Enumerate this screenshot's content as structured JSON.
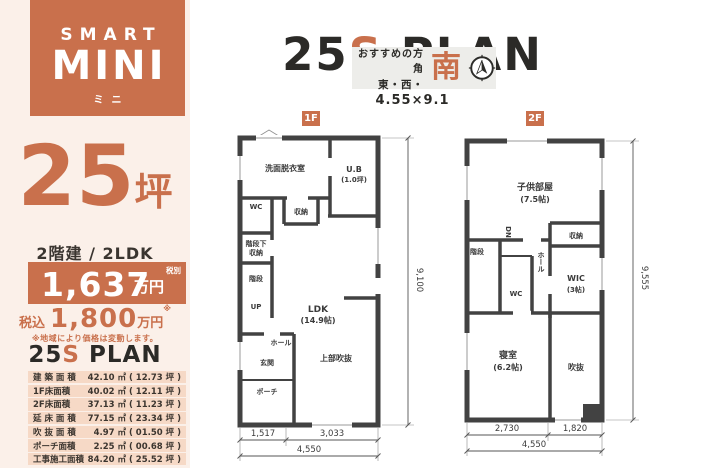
{
  "colors": {
    "accent": "#c9704c",
    "dark": "#2b2a27",
    "wall": "#424242",
    "sidebar_bg": "#fbf0e9",
    "row_bg": "#f6d9c6",
    "box_bg": "#ededea"
  },
  "brand": {
    "line1": "SMART",
    "line2": "MINI",
    "line3": "ミニ"
  },
  "sidebar": {
    "tsubo_number": "25",
    "tsubo_unit": "坪",
    "type_line": "2階建 / 2LDK",
    "price_banner": {
      "value": "1,637",
      "unit": "万円",
      "tax_note": "税別"
    },
    "tax_included": {
      "label": "税込",
      "value": "1,800",
      "unit": "万円",
      "note_mark": "※"
    },
    "disclaimer": "※地域により価格は変動します。",
    "plan_title": {
      "num": "25",
      "s": "S",
      "plan": " PLAN"
    },
    "area_table": [
      {
        "label": "建 築 面 積",
        "value": "42.10 ㎡ ( 12.73 坪 )"
      },
      {
        "label": "1F床面積",
        "value": "40.02 ㎡ ( 12.11 坪 )"
      },
      {
        "label": "2F床面積",
        "value": "37.13 ㎡ ( 11.23 坪 )"
      },
      {
        "label": "延 床 面 積",
        "value": "77.15 ㎡ ( 23.34 坪 )"
      },
      {
        "label": "吹 抜 面 積",
        "value": "4.97 ㎡ ( 01.50 坪 )"
      },
      {
        "label": "ポーチ面積",
        "value": "2.25 ㎡ ( 00.68 坪 )"
      },
      {
        "label": "工事施工面積",
        "value": "84.20 ㎡ ( 25.52 坪 )"
      }
    ]
  },
  "header": {
    "title": {
      "num": "25",
      "s": "S",
      "plan": " PLAN"
    },
    "direction": {
      "label": "おすすめの方角",
      "directions": "東・西・",
      "main_direction": "南"
    },
    "footprint": "4.55×9.1"
  },
  "floor1": {
    "tag": "1F",
    "rooms": {
      "washroom": "洗面脱衣室",
      "bath_name": "U.B",
      "bath_size": "(1.0坪)",
      "wc": "WC",
      "closet": "収納",
      "understair_1": "階段下",
      "understair_2": "収納",
      "stairs": "階段",
      "up": "UP",
      "ldk_name": "LDK",
      "ldk_size": "(14.9帖)",
      "hall": "ホール",
      "entrance": "玄関",
      "porch": "ポーチ",
      "void_above": "上部吹抜"
    },
    "dims": {
      "side": "9,100",
      "bottom_left": "1,517",
      "bottom_right": "3,033",
      "bottom_total": "4,550"
    }
  },
  "floor2": {
    "tag": "2F",
    "rooms": {
      "kids_name": "子供部屋",
      "kids_size": "(7.5帖)",
      "down": "DN",
      "closet": "収納",
      "stairs": "階段",
      "wc": "WC",
      "hall": "ホール",
      "wic_name": "WIC",
      "wic_size": "(3帖)",
      "bedroom_name": "寝室",
      "bedroom_size": "(6.2帖)",
      "void": "吹抜"
    },
    "dims": {
      "side": "9,555",
      "bottom_left": "2,730",
      "bottom_right": "1,820",
      "bottom_total": "4,550"
    }
  }
}
